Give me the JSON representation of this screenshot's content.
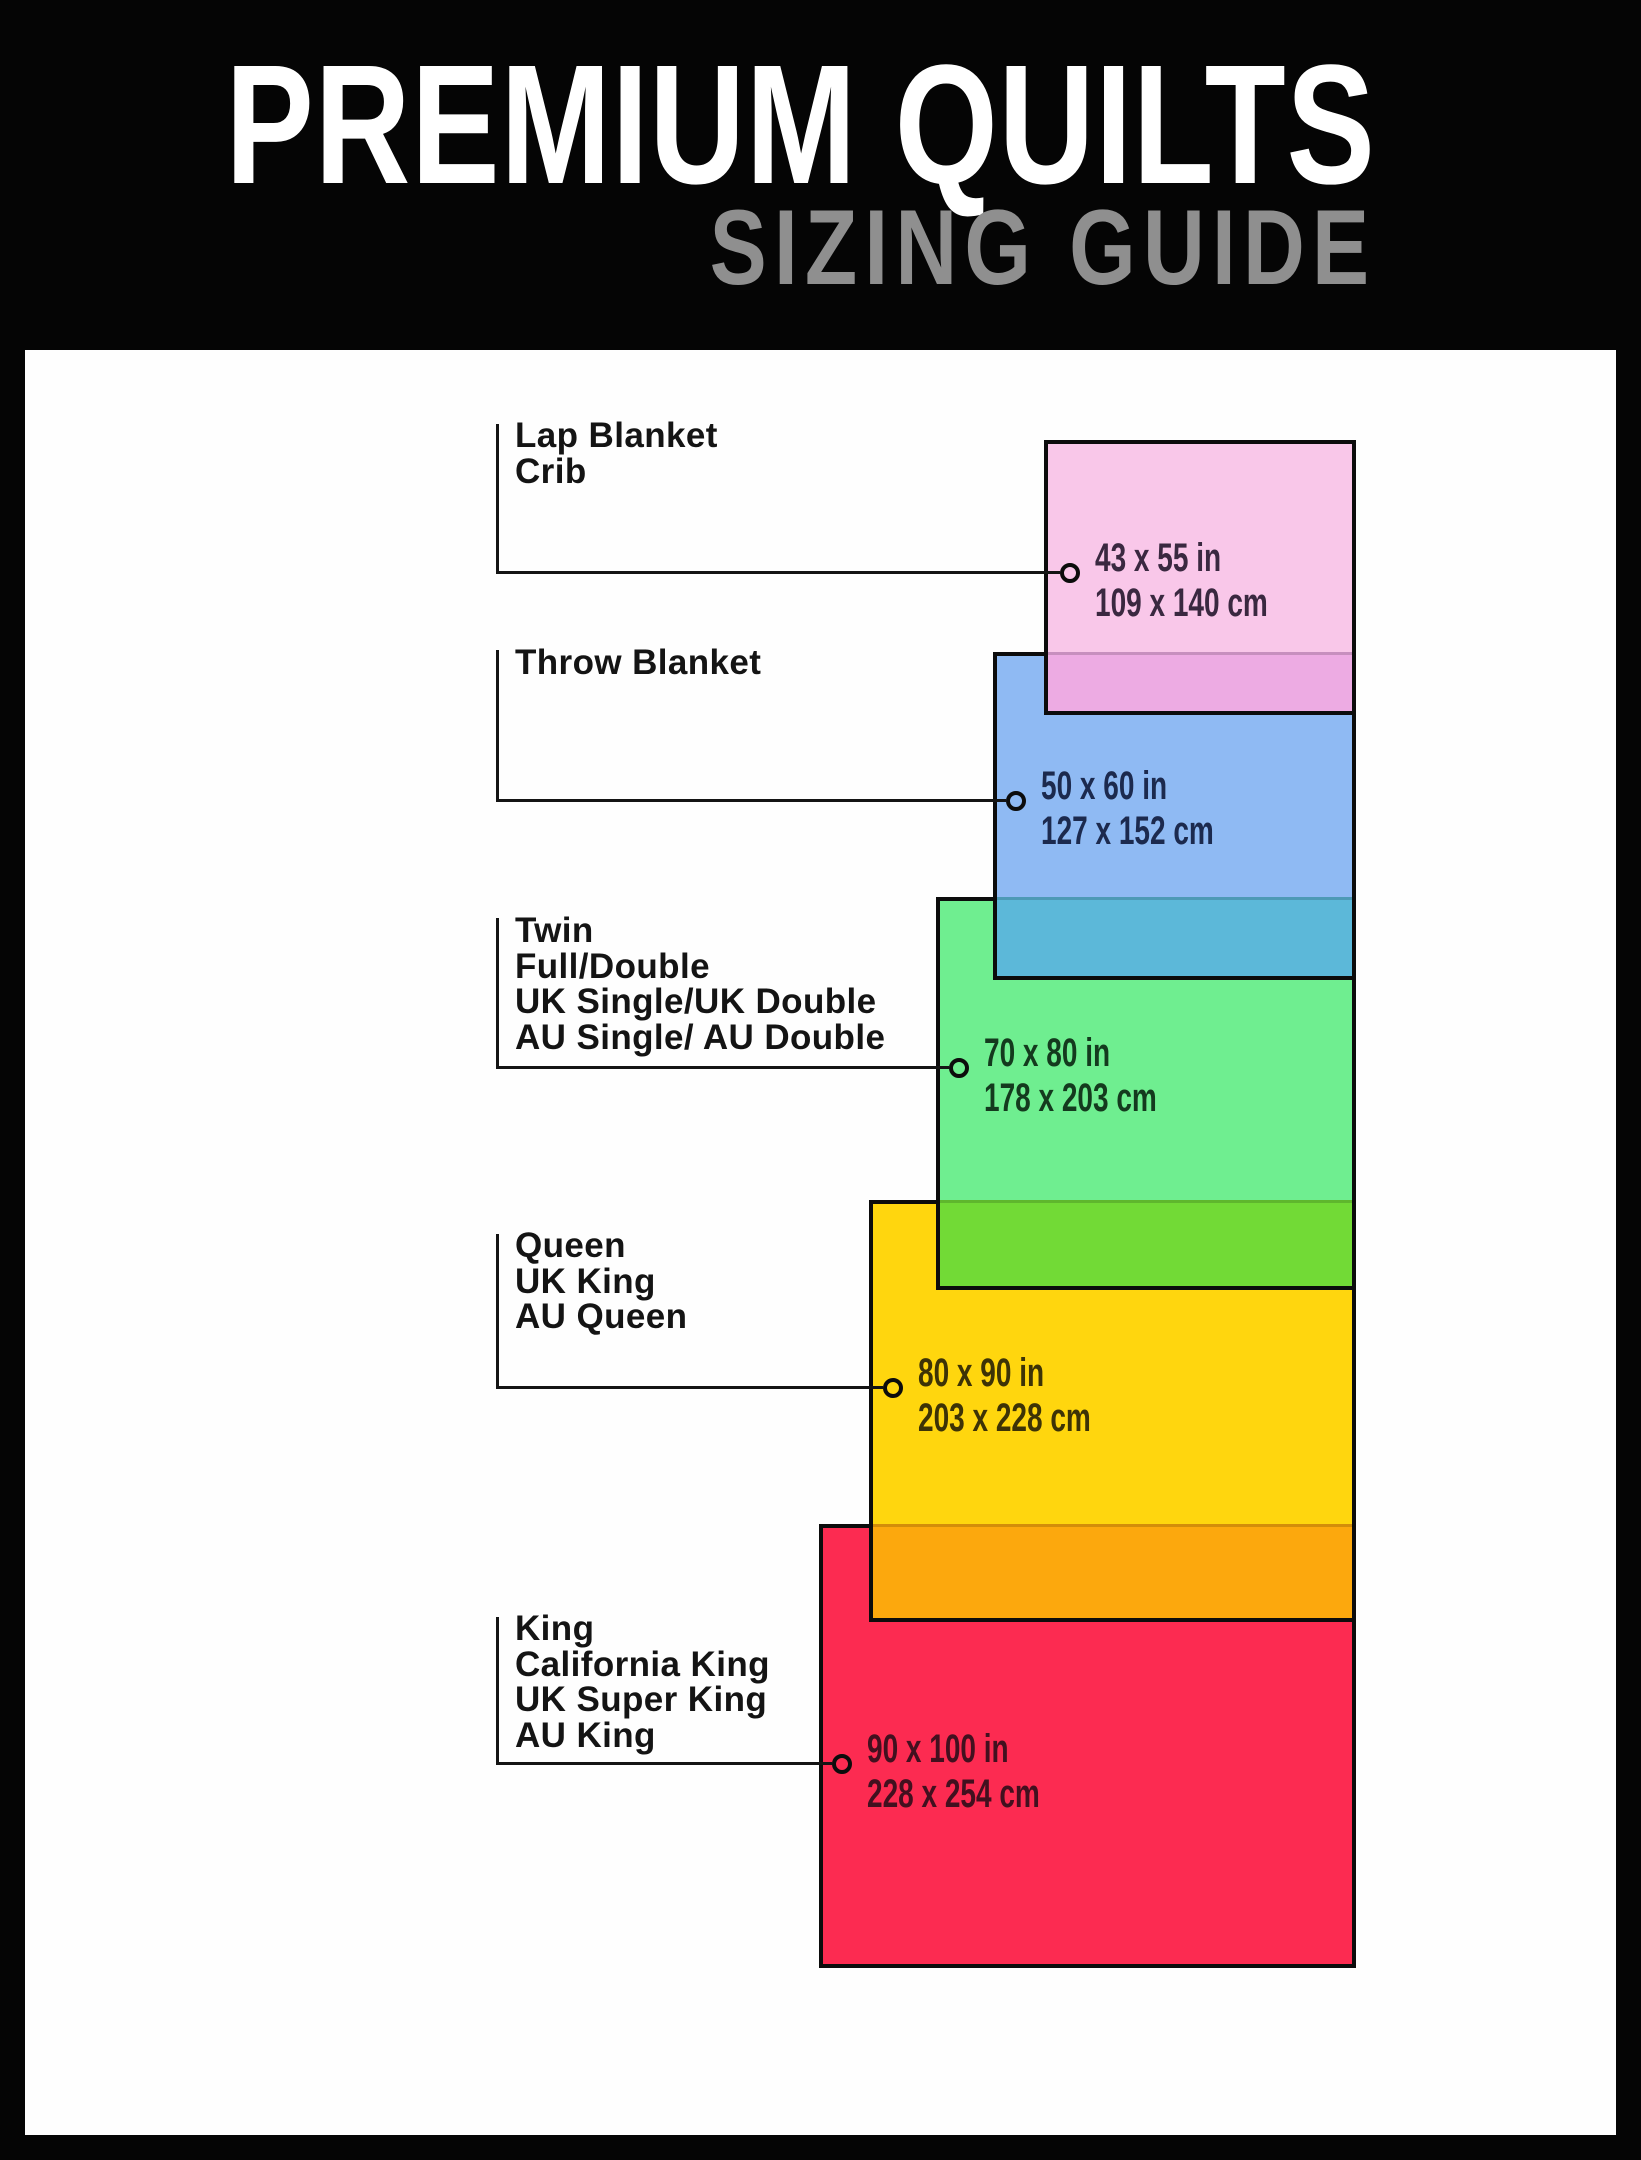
{
  "header": {
    "title": "PREMIUM QUILTS",
    "subtitle": "SIZING GUIDE"
  },
  "frame_color": "#050505",
  "board_color": "#fefefe",
  "line_color": "#141414",
  "sizes": [
    {
      "id": "lap-blanket-crib",
      "labels": [
        "Lap Blanket",
        "Crib"
      ],
      "inches": "43 x 55 in",
      "centimeters": "109 x 140 cm",
      "fill": "#f9c7e9",
      "overlap_fill": "#edabe3",
      "text_color": "#3a2840"
    },
    {
      "id": "throw-blanket",
      "labels": [
        "Throw Blanket"
      ],
      "inches": "50 x 60 in",
      "centimeters": "127 x 152 cm",
      "fill": "#8fbaf3",
      "overlap_fill": "#5cb8d9",
      "text_color": "#1c2a4e"
    },
    {
      "id": "twin-full-double",
      "labels": [
        "Twin",
        "Full/Double",
        "UK Single/UK Double",
        "AU Single/ AU Double"
      ],
      "inches": "70 x 80 in",
      "centimeters": "178 x 203 cm",
      "fill": "#6fee90",
      "overlap_fill": "#72da36",
      "text_color": "#143a1e"
    },
    {
      "id": "queen",
      "labels": [
        "Queen",
        "UK King",
        "AU Queen"
      ],
      "inches": "80 x 90 in",
      "centimeters": "203 x 228 cm",
      "fill": "#ffd60e",
      "overlap_fill": "#fca80d",
      "text_color": "#3d3306"
    },
    {
      "id": "king",
      "labels": [
        "King",
        "California King",
        "UK Super King",
        "AU King"
      ],
      "inches": "90 x 100 in",
      "centimeters": "228 x 254 cm",
      "fill": "#fc2b51",
      "overlap_fill": "#fc2b51",
      "text_color": "#42101f"
    }
  ]
}
